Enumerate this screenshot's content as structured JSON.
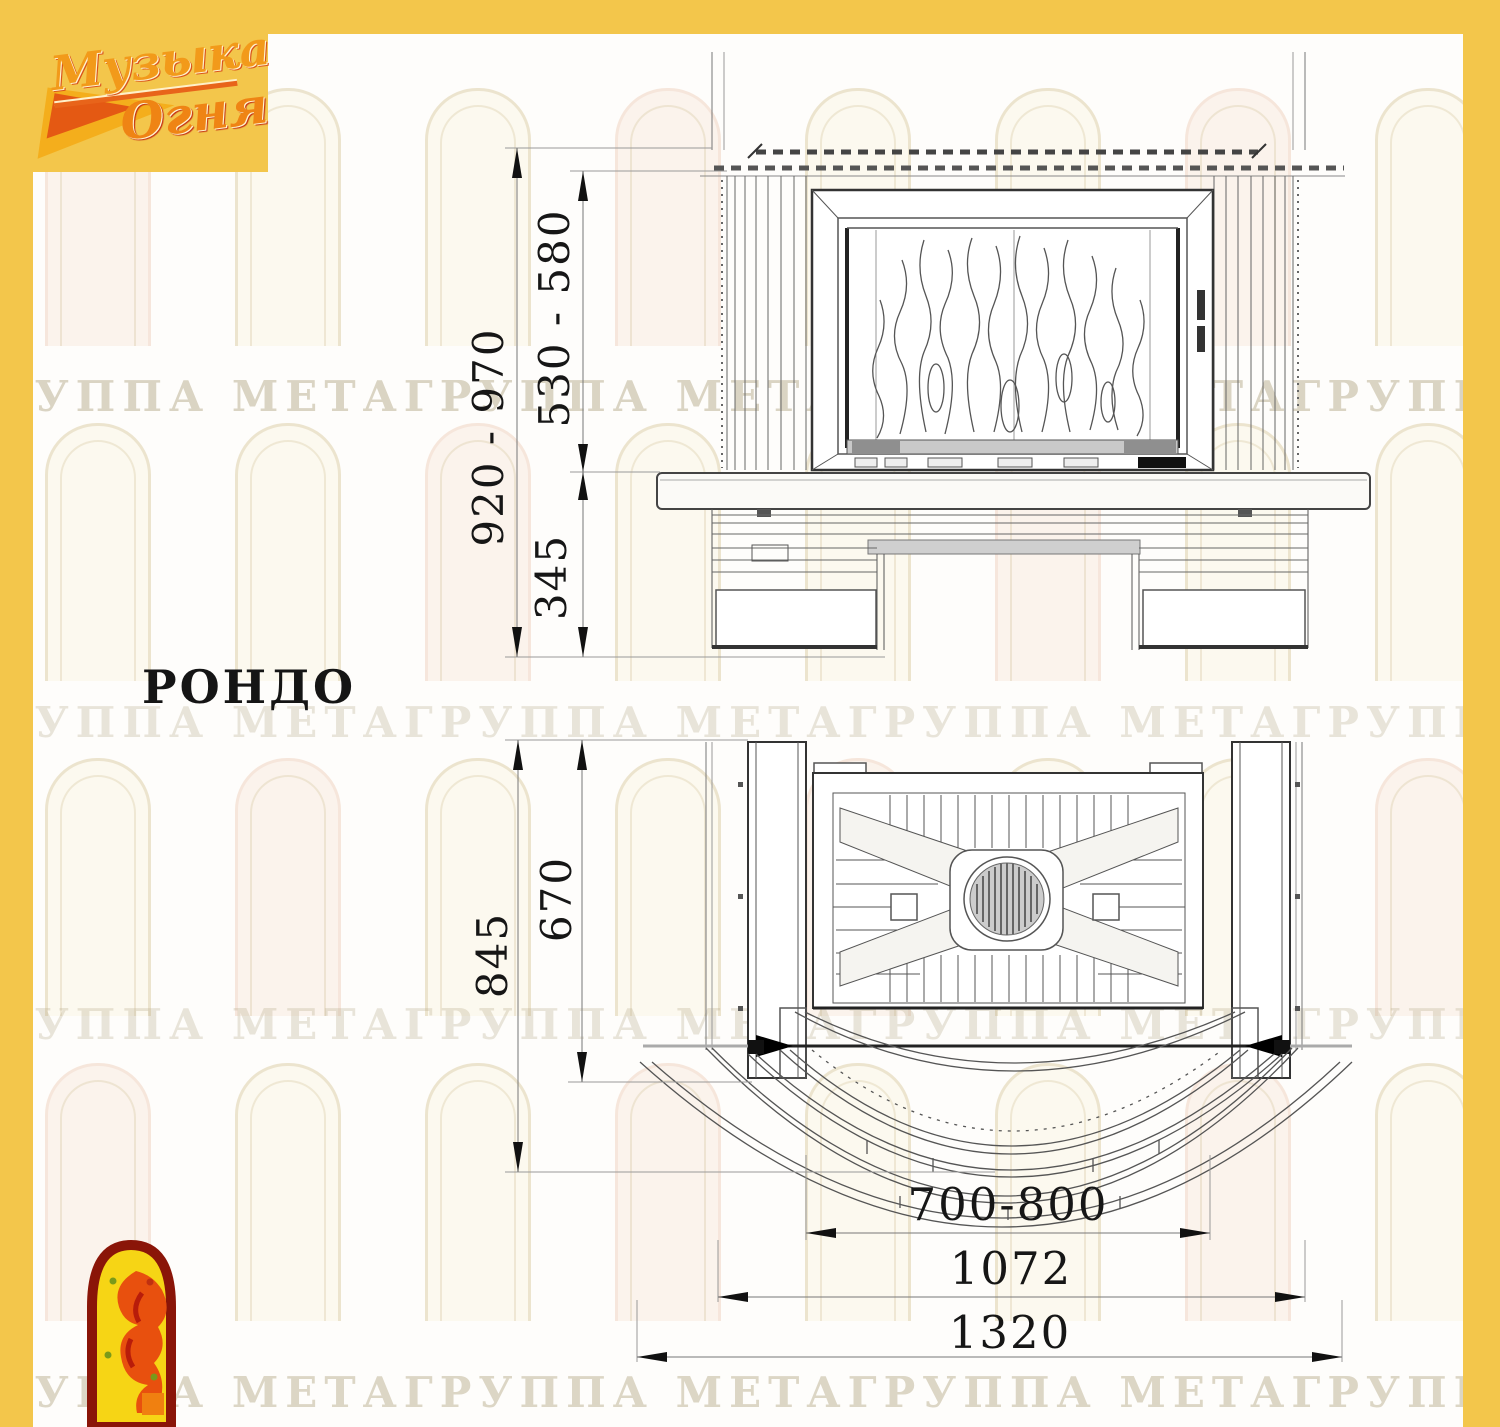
{
  "colors": {
    "frame_yellow": "#f3c64b",
    "drawing_line": "#555555",
    "drawing_dark": "#222222",
    "dim_text": "#161616",
    "watermark_text": "#b8ac8c",
    "logo_orange": "#f29a1a",
    "logo_red": "#c22c10",
    "jester_border": "#8a1508",
    "jester_fill": "#f6d515"
  },
  "logo": {
    "line1": "Музыка",
    "line2": "Огня"
  },
  "title": "РОНДО",
  "watermark": {
    "text": "ГРУППА МЕТАГРУППА МЕТАГРУППА МЕТАГРУППА МЕТАГРУППА МЕТА"
  },
  "front_view": {
    "label": "front-elevation-drawing",
    "dims": {
      "overall_height": "920 - 970",
      "firebox_height": "530 - 580",
      "base_height": "345"
    }
  },
  "plan_view": {
    "label": "top-plan-drawing",
    "dims": {
      "overall_depth": "845",
      "inner_depth": "670",
      "firebox_width": "700-800",
      "hearth_width": "1072",
      "overall_width": "1320"
    }
  }
}
